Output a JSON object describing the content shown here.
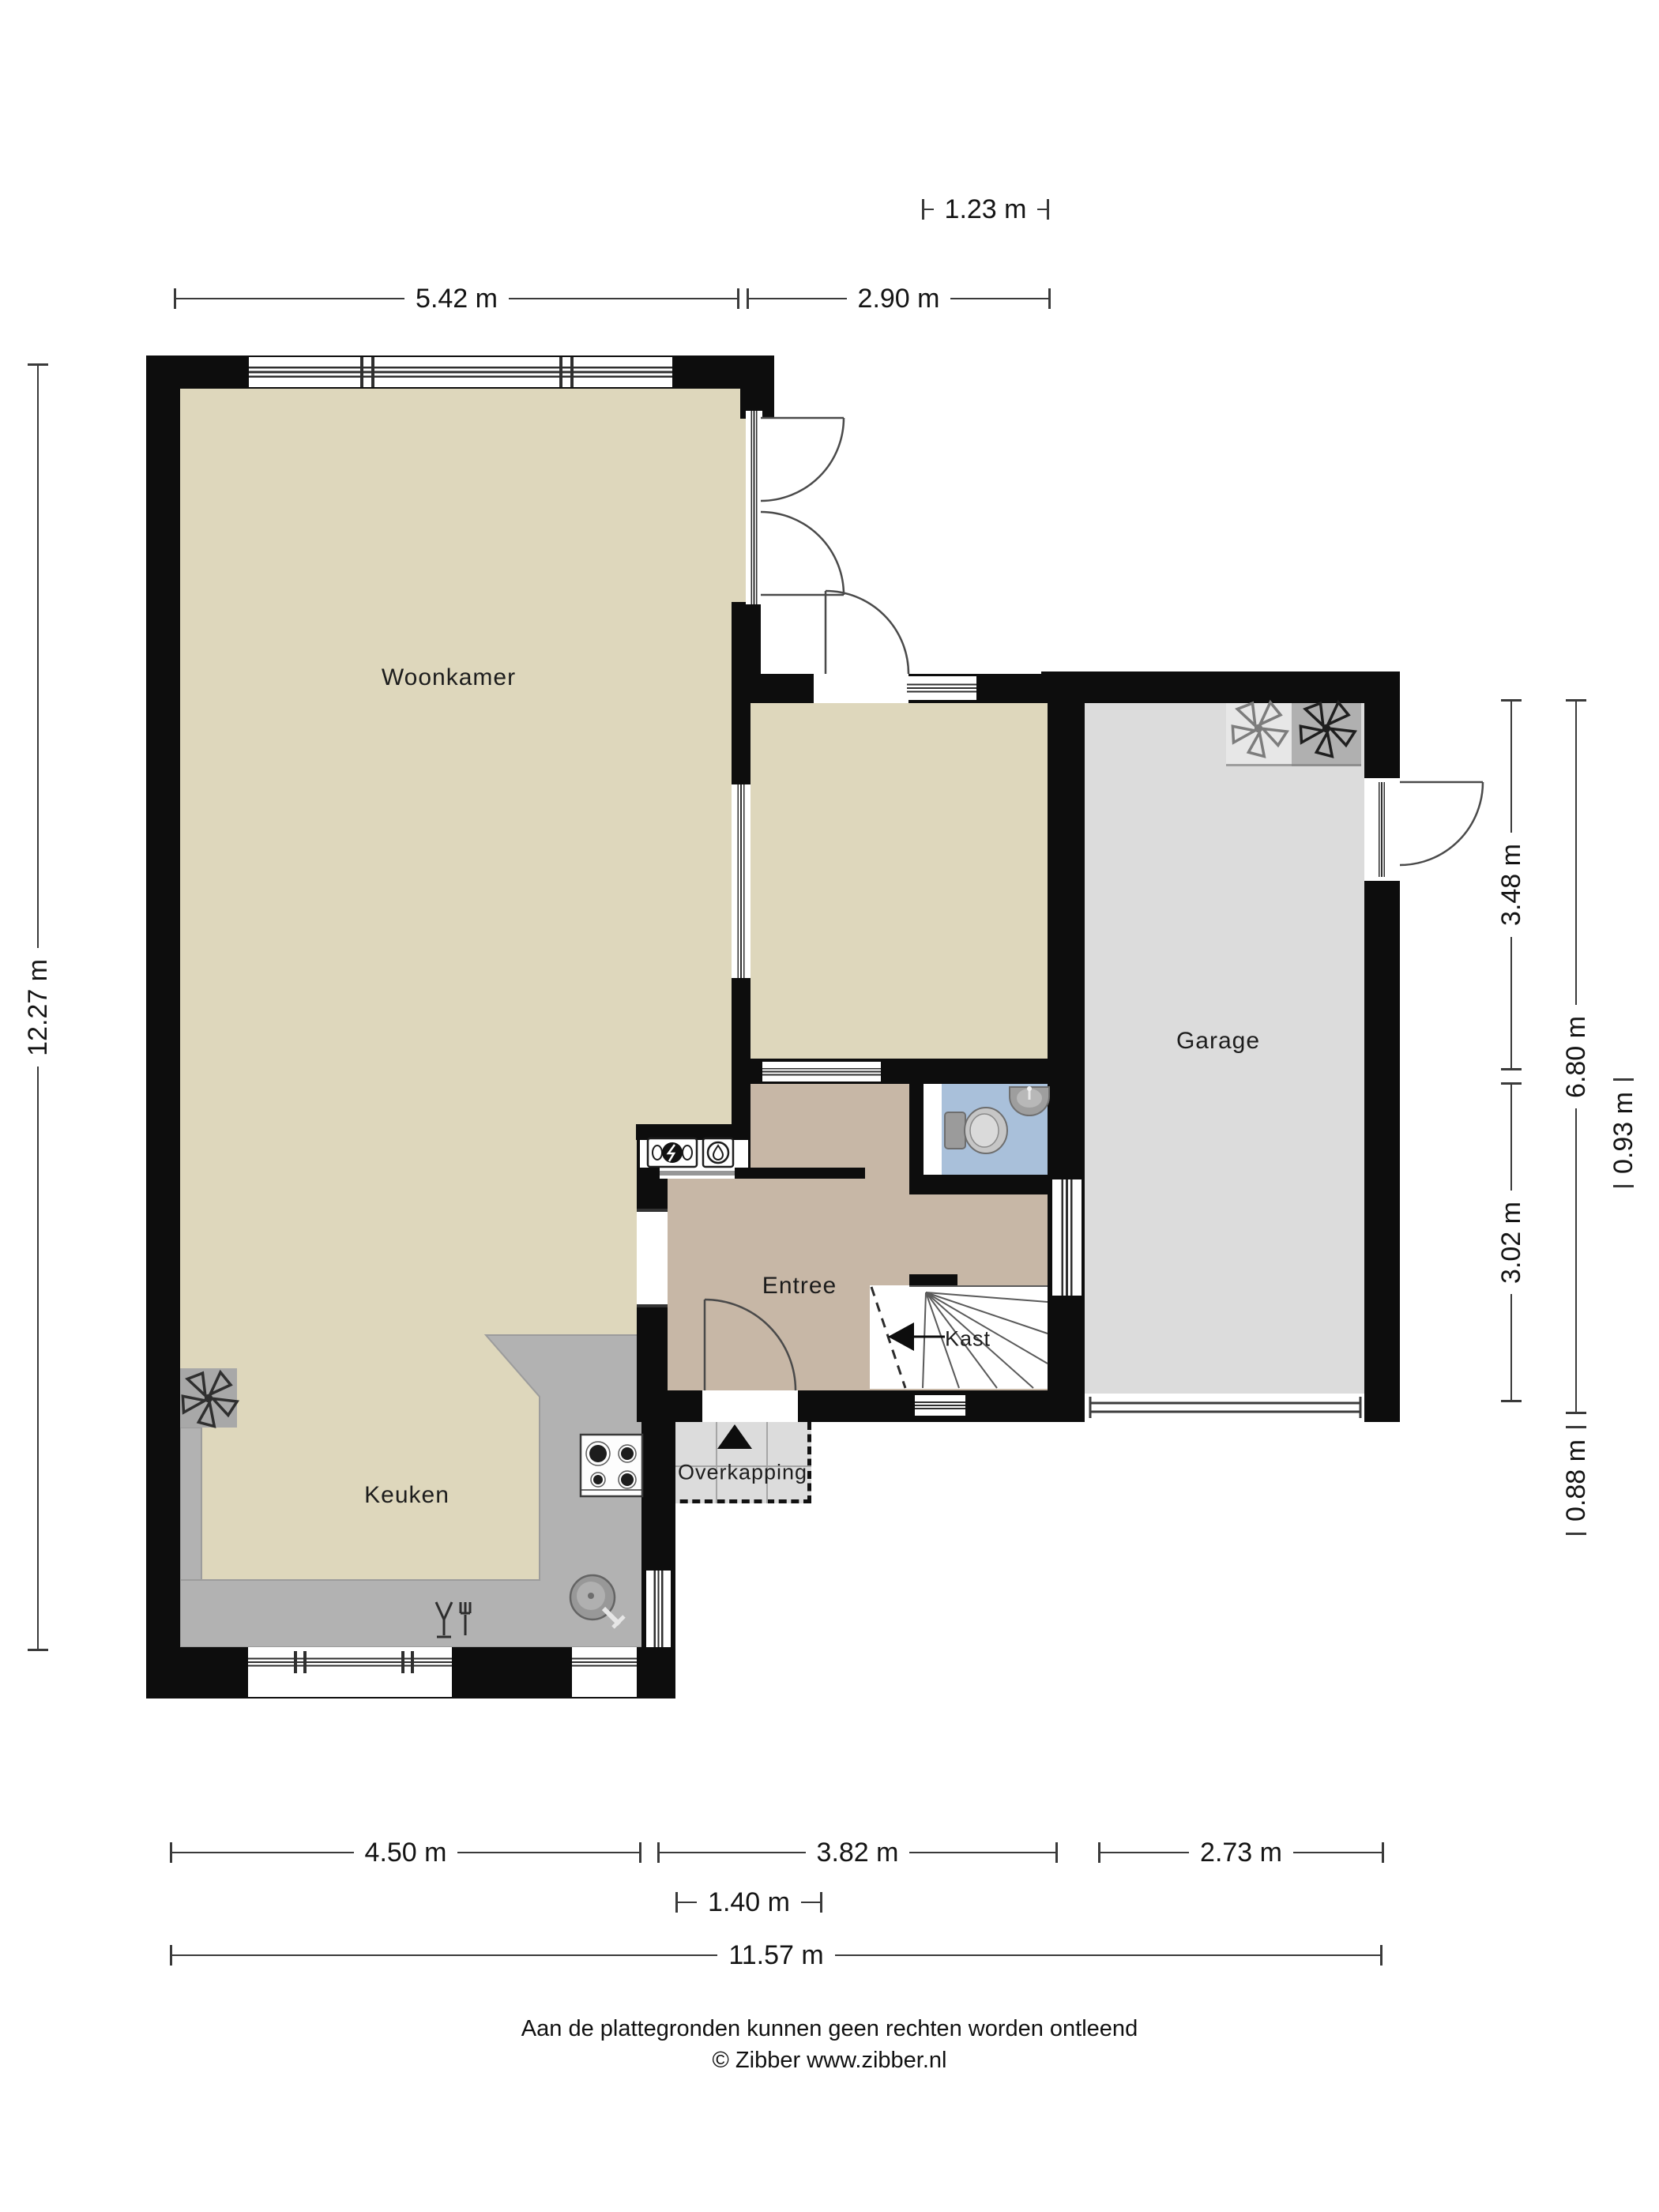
{
  "plan": {
    "rooms": {
      "woonkamer": "Woonkamer",
      "keuken": "Keuken",
      "entree": "Entree",
      "kast": "Kast",
      "garage": "Garage",
      "overkapping": "Overkapping"
    },
    "dimensions": {
      "top_small": "1.23 m",
      "top_left": "5.42 m",
      "top_right": "2.90 m",
      "left_total": "12.27 m",
      "right_inner_top": "3.48 m",
      "right_inner_bottom": "3.02 m",
      "right_outer": "6.80 m",
      "right_small": "0.93 m",
      "right_bottom_small": "0.88 m",
      "bottom_left": "4.50 m",
      "bottom_middle": "3.82 m",
      "bottom_right": "2.73 m",
      "bottom_door": "1.40 m",
      "bottom_total": "11.57 m"
    },
    "footer": {
      "disclaimer": "Aan de plattegronden kunnen geen rechten worden ontleend",
      "credit": "© Zibber www.zibber.nl"
    },
    "colors": {
      "wall": "#0d0d0d",
      "living_floor": "#ded7bc",
      "entree_floor": "#c7b7a6",
      "toilet_floor": "#a9c0da",
      "garage_floor": "#dcdcdc",
      "counter": "#b2b2b2",
      "overkapping_floor": "#dcdcdc"
    }
  }
}
